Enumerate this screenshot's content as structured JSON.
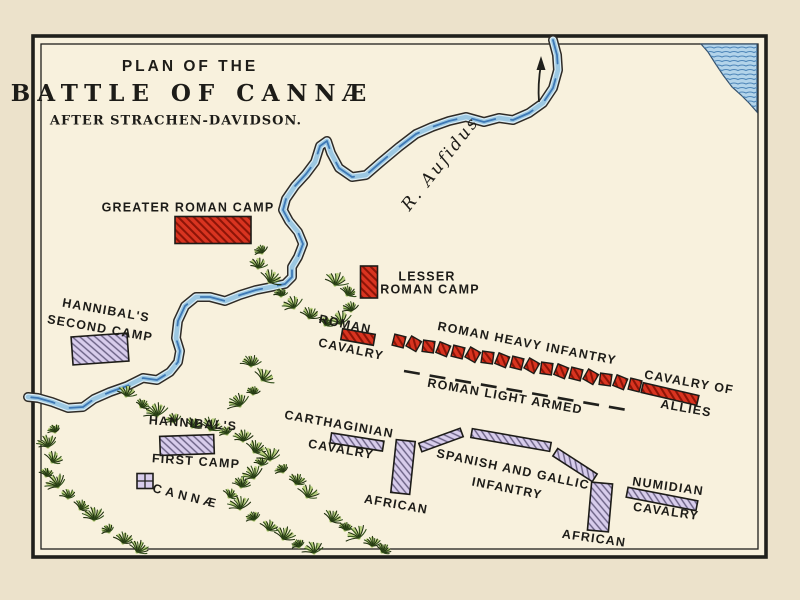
{
  "map": {
    "title_line1": "PLAN OF THE",
    "title_line2": "BATTLE OF CANNÆ",
    "title_line3": "AFTER STRACHEN-DAVIDSON.",
    "river_label": "R. Aufidus",
    "labels": {
      "greater_roman_camp": "GREATER ROMAN CAMP",
      "lesser_roman_camp_line1": "LESSER",
      "lesser_roman_camp_line2": "ROMAN CAMP",
      "hannibals_second_camp_line1": "HANNIBAL'S",
      "hannibals_second_camp_line2": "SECOND CAMP",
      "roman_cavalry_line1": "ROMAN",
      "roman_cavalry_line2": "CAVALRY",
      "roman_heavy_infantry": "ROMAN HEAVY INFANTRY",
      "roman_light_armed": "ROMAN LIGHT ARMED",
      "cavalry_of_allies_line1": "CAVALRY OF",
      "cavalry_of_allies_line2": "ALLIES",
      "hannibals_first_camp_line1": "HANNIBAL'S",
      "hannibals_first_camp_line2": "FIRST CAMP",
      "cannae_town": "CANNÆ",
      "carthaginian_cavalry_line1": "CARTHAGINIAN",
      "carthaginian_cavalry_line2": "CAVALRY",
      "spanish_gallic_line1": "SPANISH AND GALLIC",
      "spanish_gallic_line2": "INFANTRY",
      "african_left": "AFRICAN",
      "african_right": "AFRICAN",
      "numidian_cavalry_line1": "NUMIDIAN",
      "numidian_cavalry_line2": "CAVALRY"
    },
    "counts": {
      "roman_heavy_infantry_squares": 17
    },
    "colors": {
      "page_margin": "#ece2cb",
      "map_background": "#f8f1dd",
      "frame_ink": "#20201c",
      "label_ink": "#1d1c18",
      "roman_fill": "#d93420",
      "roman_hatch": "#8c1407",
      "carthaginian_fill": "#d8cdec",
      "carthaginian_hatch": "#696083",
      "river_edge": "#2f2b26",
      "river_light": "#d9ecf5",
      "river_mid": "#9cc8e2",
      "river_dark": "#3e78b5",
      "sea_fill": "#b3d4ea",
      "sea_wave": "#4e86b8",
      "veg_dark": "#32501c",
      "veg_ink": "#20300f",
      "veg_light": "#b8cf7d"
    }
  }
}
